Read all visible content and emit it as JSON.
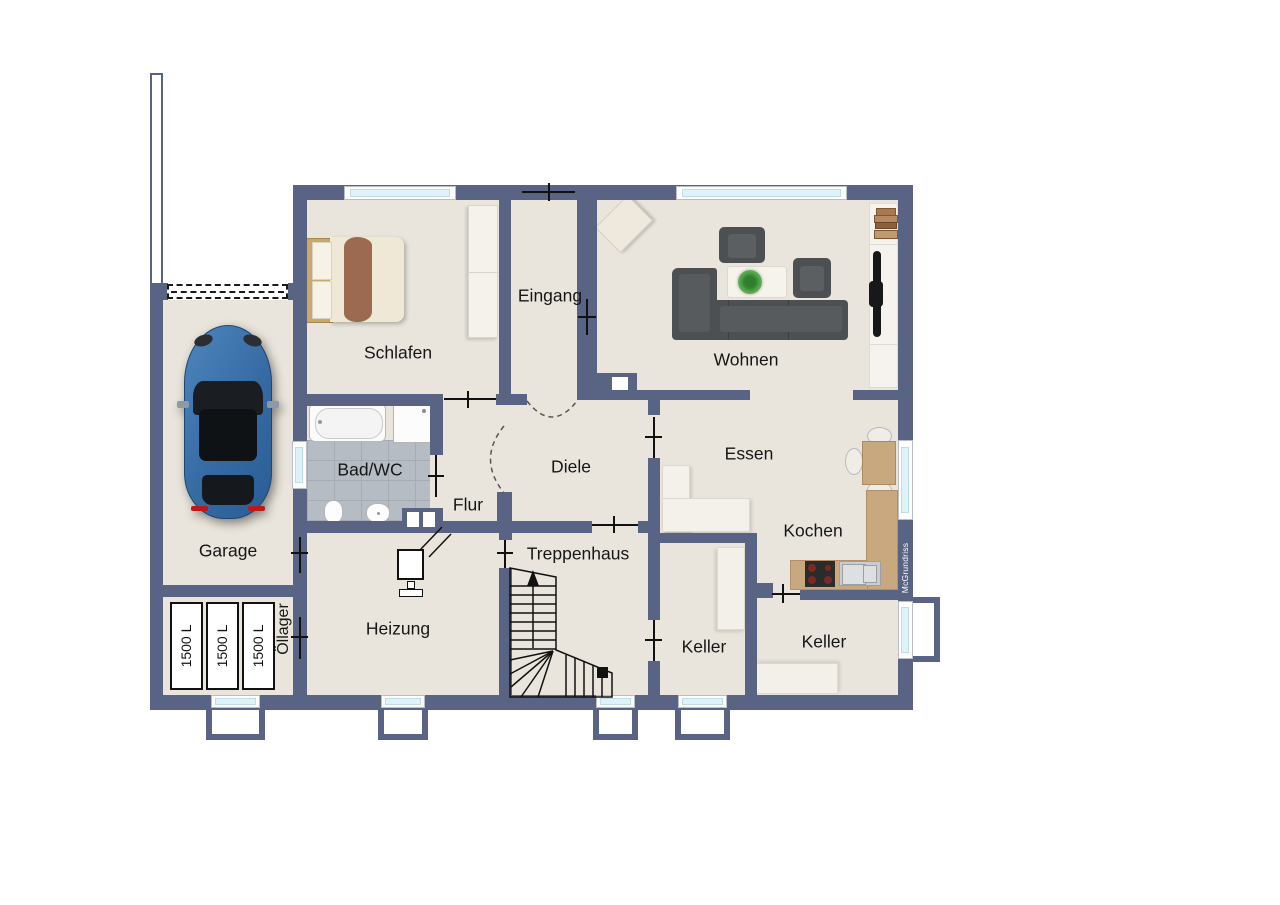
{
  "rooms": {
    "schlafen": "Schlafen",
    "eingang": "Eingang",
    "wohnen": "Wohnen",
    "bad": "Bad/WC",
    "flur": "Flur",
    "diele": "Diele",
    "essen": "Essen",
    "kochen": "Kochen",
    "garage": "Garage",
    "heizung": "Heizung",
    "treppenhaus": "Treppenhaus",
    "keller_left": "Keller",
    "keller_right": "Keller",
    "oellager": "Öllager"
  },
  "tanks": {
    "label": "1500 L",
    "count": 3
  },
  "watermark": "McGrundriss",
  "colors": {
    "wall": "#596484",
    "floor": "#e9e5dc",
    "window_glass": "#ddf3f7",
    "bath_tile": "#b6bcc3",
    "kitchen_counter": "#c8a87e",
    "sofa": "#4d5052",
    "car": "#3c74ad"
  }
}
